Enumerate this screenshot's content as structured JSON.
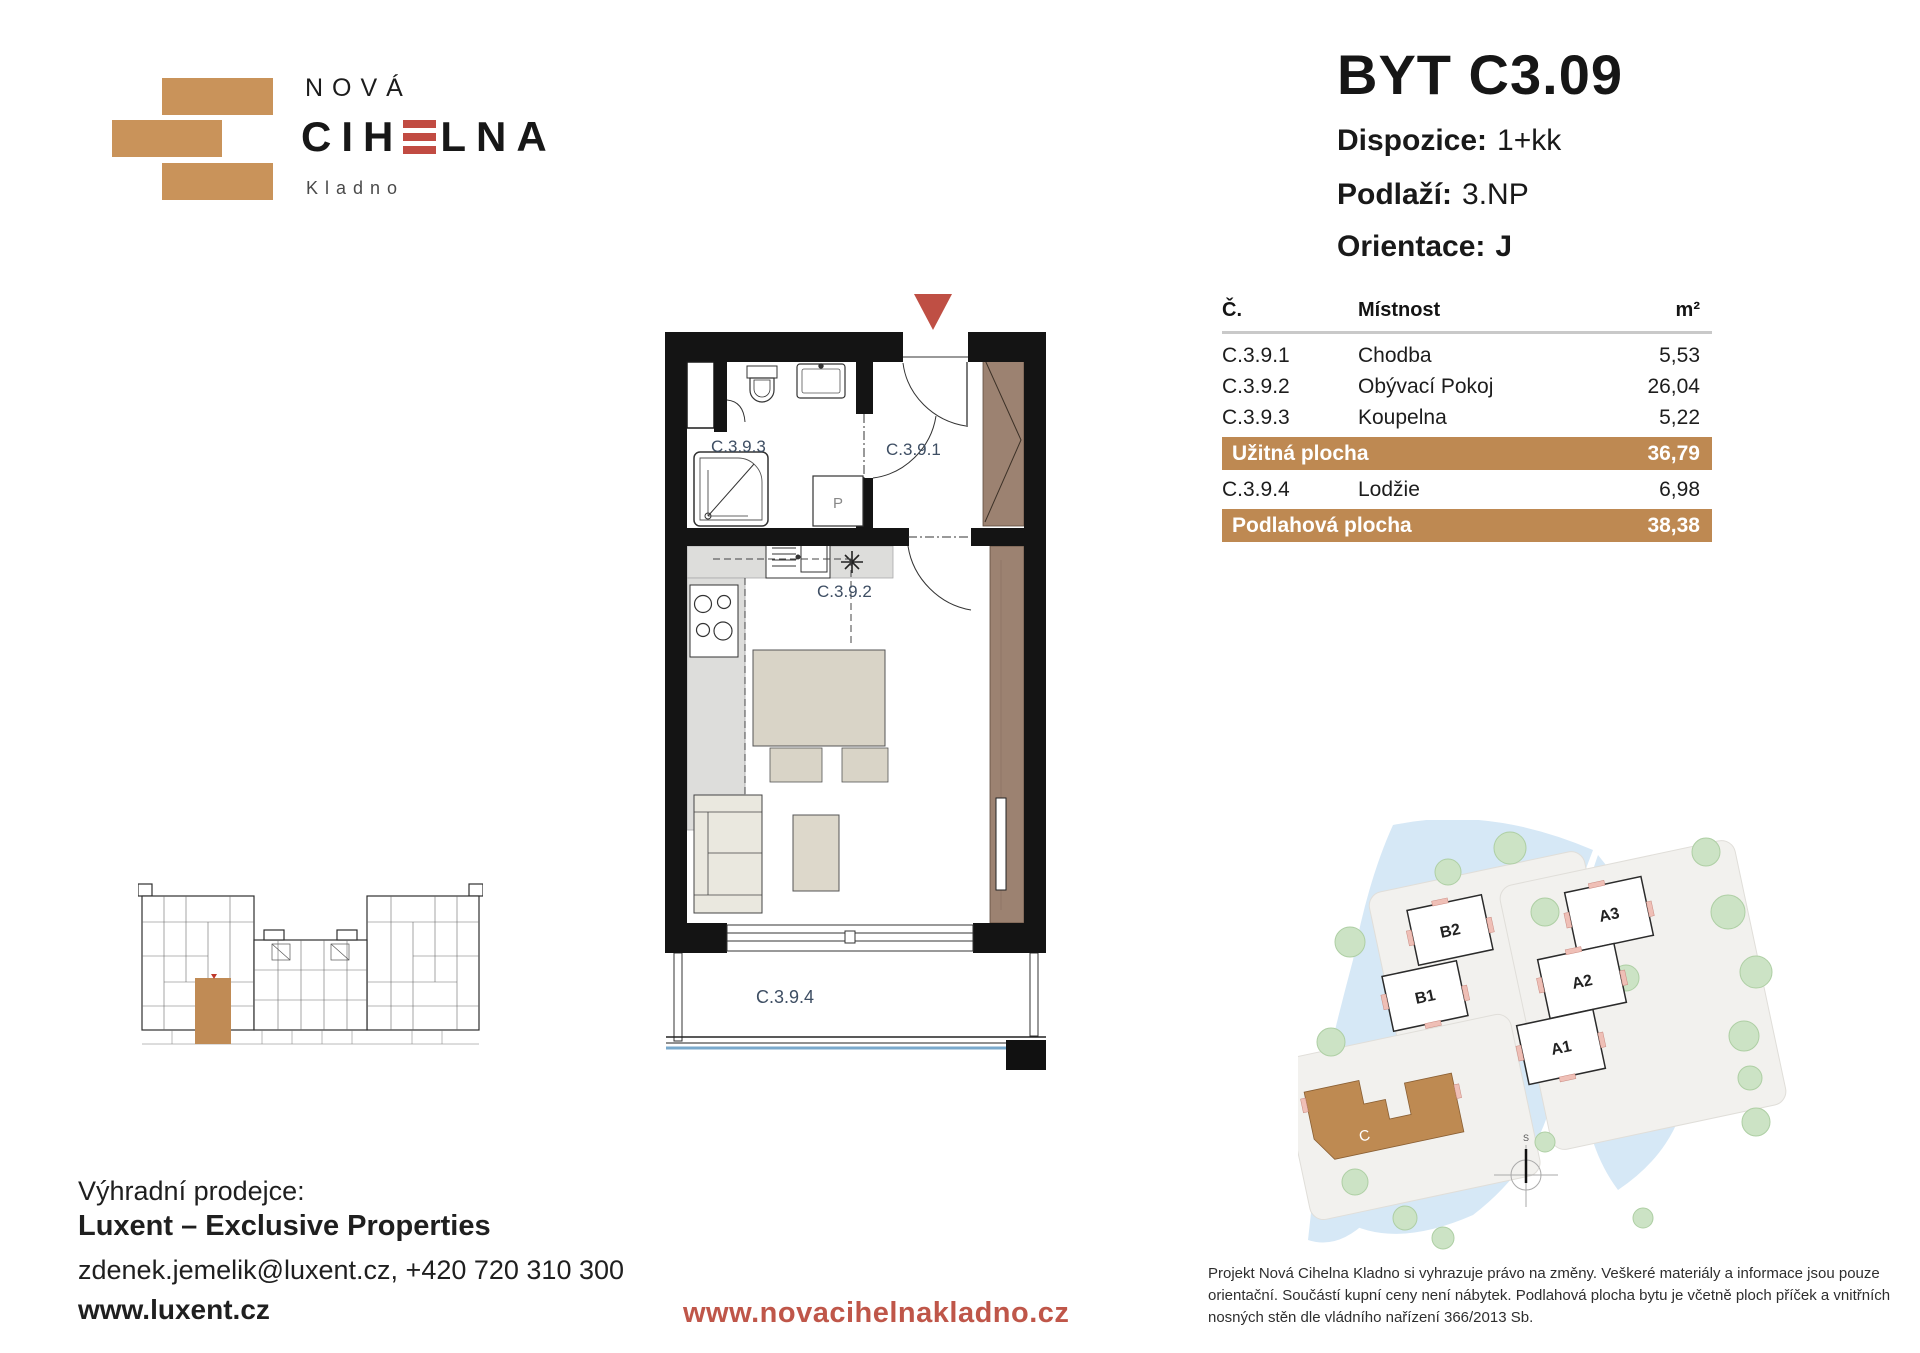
{
  "logo": {
    "word_top": "NOVÁ",
    "word_main_pre": "CIH",
    "word_main_post": "LNA",
    "city": "Kladno"
  },
  "header": {
    "title": "BYT C3.09",
    "specs": [
      {
        "label": "Dispozice:",
        "value": "1+kk"
      },
      {
        "label": "Podlaží:",
        "value": "3.NP"
      },
      {
        "label": "Orientace:",
        "value": "J"
      }
    ]
  },
  "room_table": {
    "headers": {
      "number": "Č.",
      "room": "Místnost",
      "area": "m²"
    },
    "rows": [
      {
        "number": "C.3.9.1",
        "room": "Chodba",
        "area": "5,53"
      },
      {
        "number": "C.3.9.2",
        "room": "Obývací Pokoj",
        "area": "26,04"
      },
      {
        "number": "C.3.9.3",
        "room": "Koupelna",
        "area": "5,22"
      }
    ],
    "usable": {
      "label": "Užitná plocha",
      "area": "36,79"
    },
    "extra_row": {
      "number": "C.3.9.4",
      "room": "Lodžie",
      "area": "6,98"
    },
    "total": {
      "label": "Podlahová plocha",
      "area": "38,38"
    }
  },
  "floorplan": {
    "labels": {
      "bathroom": "C.3.9.3",
      "hall": "C.3.9.1",
      "living": "C.3.9.2",
      "loggia": "C.3.9.4"
    },
    "washer": "P"
  },
  "site_plan": {
    "buildings": {
      "b2": "B2",
      "b1": "B1",
      "a3": "A3",
      "a2": "A2",
      "a1": "A1",
      "c": "C"
    },
    "compass": "S"
  },
  "seller": {
    "intro": "Výhradní prodejce:",
    "name": "Luxent – Exclusive Properties",
    "contact": "zdenek.jemelik@luxent.cz, +420 720 310 300",
    "web": "www.luxent.cz"
  },
  "footer": {
    "project_url": "www.novacihelnakladno.cz",
    "disclaimer_lines": [
      "Projekt Nová Cihelna Kladno si vyhrazuje právo na změny. Veškeré materiály a informace jsou pouze",
      "orientační. Součástí kupní ceny není nábytek. Podlahová plocha bytu je včetně ploch příček a vnitřních",
      "nosných stěn dle vládního nařízení 366/2013 Sb."
    ]
  },
  "colors": {
    "brick_logo": "#C9935A",
    "table_band": "#BE8952",
    "accent_red": "#BF5649",
    "logo_e_red": "#C14B42",
    "plan_label_blue": "#3E4E63",
    "balcony_blue": "#79A9CC",
    "highlight_unit": "#C08B55"
  }
}
